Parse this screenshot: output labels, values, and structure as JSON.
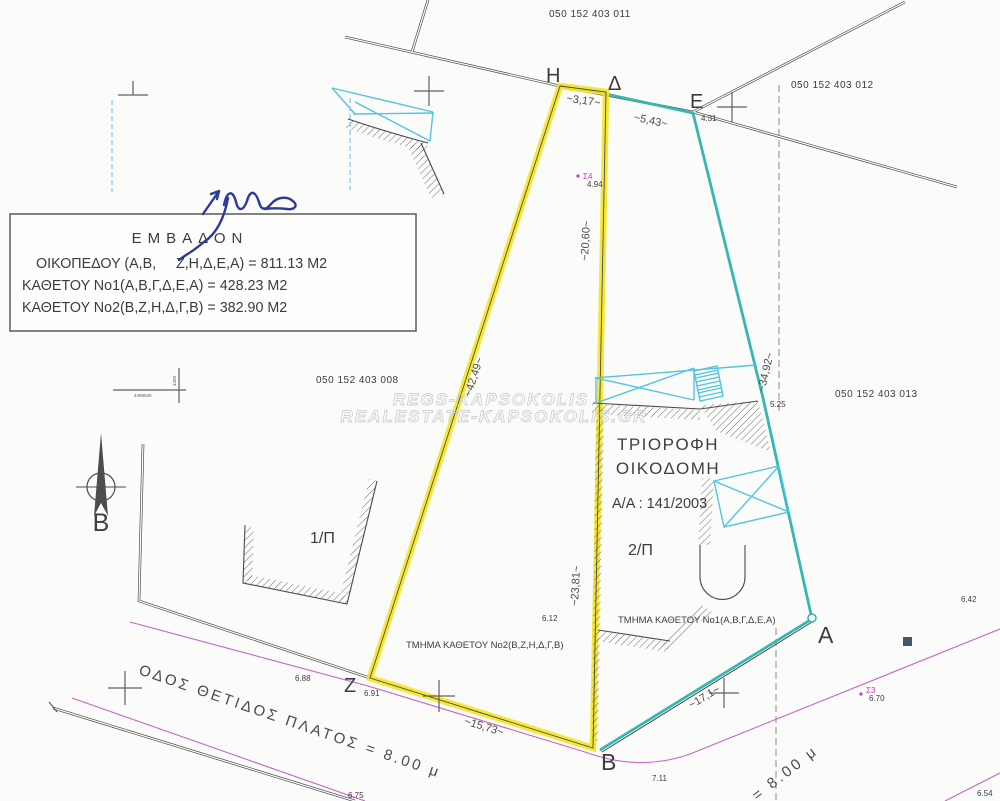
{
  "plan": {
    "parcels": {
      "p011": "050 152 403 011",
      "p012": "050 152 403 012",
      "p008": "050 152 403 008",
      "p013": "050 152 403 013"
    },
    "box": {
      "title": "ΕΜΒΑΔΟΝ",
      "r1": "ΟΙΚΟΠΕΔΟΥ (Α,Β,     Ζ,Η,Δ,Ε,Α) = 811.13 Μ2",
      "r2": "ΚΑΘΕΤΟΥ Νο1(Α,Β,Γ,Δ,Ε,Α) = 428.23 Μ2",
      "r3": "ΚΑΘΕΤΟΥ Νο2(Β,Ζ,Η,Δ,Γ,Β) = 382.90 Μ2"
    },
    "pts": {
      "h": "Η",
      "d": "Δ",
      "e": "Ε",
      "a": "Α",
      "b": "Β",
      "z": "Ζ"
    },
    "dims": {
      "hd": "~3,17~",
      "de": "~5,43~",
      "dg": "~20,60~",
      "gb": "~23,81~",
      "zh": "~42,49~",
      "ea": "~34,92~",
      "zb": "~15,73~",
      "ba": "~17,1~"
    },
    "elev": {
      "s4v": "4.94",
      "e431": "4.31",
      "e525": "5.25",
      "e612": "6.12",
      "e688": "6.88",
      "e691": "6.91",
      "e711": "7.11",
      "e670": "6.70",
      "e642": "6.42",
      "e654": "6.54",
      "e675": "6.75"
    },
    "st": {
      "s3": "Σ3",
      "s4": "Σ4"
    },
    "bld": {
      "n1": "ΤΡΙΟΡΟΦΗ",
      "n2": "ΟΙΚΟΔΟΜΗ",
      "permit": "Α/Α : 141/2003",
      "f1": "1/Π",
      "f2": "2/Π",
      "sec1": "ΤΜΗΜΑ ΚΑΘΕΤΟΥ Νο1(Α,Β,Γ,Δ,Ε,Α)",
      "sec2": "ΤΜΗΜΑ ΚΑΘΕΤΟΥ Νο2(Β,Ζ,Η,Δ,Γ,Β)"
    },
    "roads": {
      "main": "ΟΔΟΣ ΘΕΤΙΔΟΣ ΠΛΑΤΟΣ = 8.00 μ",
      "east": "= 8.00 μ"
    },
    "north": "Β",
    "grid": {
      "h": "4499040",
      "v": "4493"
    },
    "wm": {
      "l1": "REGS-KAPSOKOLIS",
      "l2": "REALESTATE-KAPSOKOLIS.GR"
    },
    "colors": {
      "highlight": "#f4e41f",
      "boundary_teal": "#35b7b3",
      "structure_cyan": "#52c5e2",
      "road_magenta": "#c565c5",
      "ink_blue": "#2c3a9a"
    }
  }
}
